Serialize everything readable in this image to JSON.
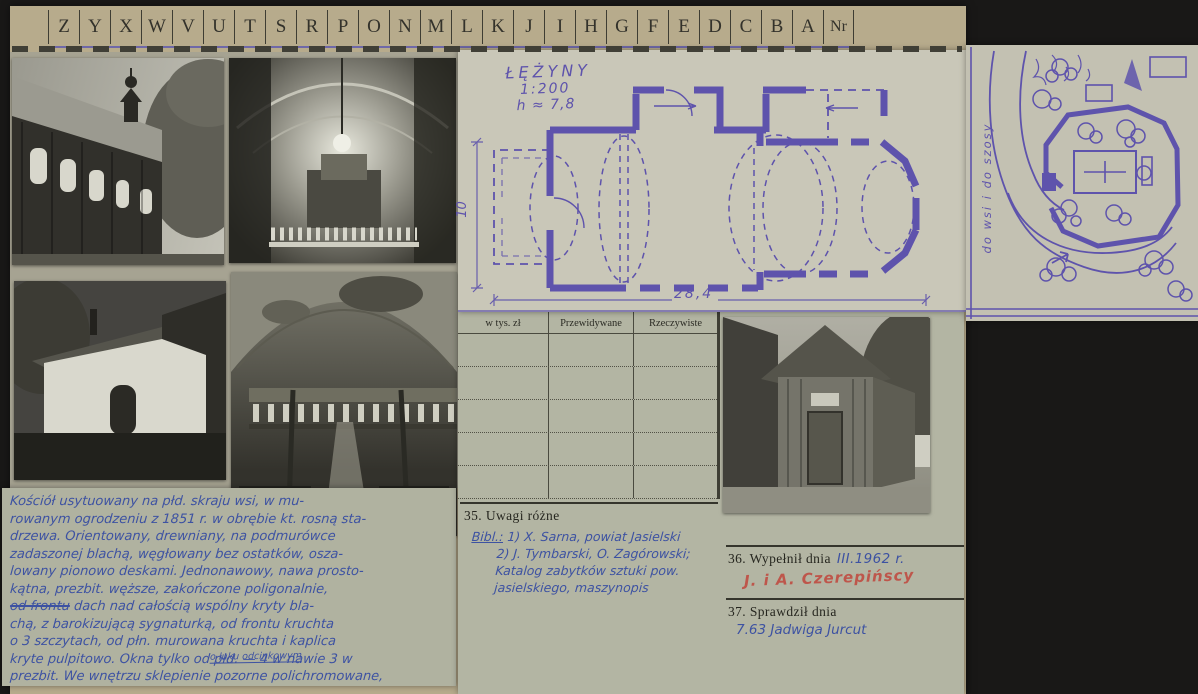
{
  "index_strip": {
    "letters": [
      "Z",
      "Y",
      "X",
      "W",
      "V",
      "U",
      "T",
      "S",
      "R",
      "P",
      "O",
      "N",
      "M",
      "L",
      "K",
      "J",
      "I",
      "H",
      "G",
      "F",
      "E",
      "D",
      "C",
      "B",
      "A"
    ],
    "last": "Nr"
  },
  "plan": {
    "title": "ŁĘŻYNY",
    "scale": "1:200",
    "height_note": "h ≈ 7,8",
    "width_dim": "28,4",
    "side_dim": "10"
  },
  "site_plan": {
    "road_label": "do wsi i do szosy"
  },
  "finance_table": {
    "col1": "w tys. zł",
    "col2": "Przewidywane",
    "col3": "Rzeczywiste"
  },
  "uwagi": {
    "label": "35. Uwagi różne",
    "lead": "Bibl.:",
    "line1": "1) X. Sarna, powiat Jasielski",
    "line2": "2) J. Tymbarski, O. Zagórowski;",
    "line3": "Katalog zabytków sztuki pow.",
    "line4": "jasielskiego, maszynopis"
  },
  "wypelnil": {
    "label": "36. Wypełnił dnia",
    "date": "III.1962 r.",
    "stamp": "J. i A. Czerepińscy"
  },
  "sprawdzil": {
    "label": "37. Sprawdził dnia",
    "note": "7.63 Jadwiga Jurcut"
  },
  "description": {
    "l0": "Kościół usytuowany na płd. skraju wsi, w mu-",
    "l1": "rowanym ogrodzeniu z 1851 r. w obrębie kt. rosną sta-",
    "l2": "drzewa. Orientowany, drewniany, na podmurówce",
    "l3": "zadaszonej blachą, węgłowany bez ostatków, osza-",
    "l4": "lowany pionowo deskami. Jednonawowy, nawa prosto-",
    "l5": "kątna, prezbit. węższe, zakończone poligonalnie,",
    "l6_struck": "od frontu",
    "l6": " dach nad całością wspólny kryty bla-",
    "l7": "chą, z barokizującą sygnaturką, od frontu kruchta",
    "l8": "o 3 szczytach, od płn. murowana kruchta i kaplica",
    "l9": "kryte pulpitowo. Okna tylko od płd. — 4 w nawie 3 w",
    "l10": "prezbit. We wnętrzu sklepienie pozorne polichromowane,",
    "insert": "o łuku odcinkowym"
  },
  "photos": {
    "p1": "wooden church exterior, south wall with ridge turret",
    "p2": "interior toward main altar",
    "p3": "plastered annex with arched doorway",
    "p4": "interior toward organ loft",
    "p5": "wooden porch with tented roof"
  },
  "colors": {
    "ink_purple": "#5e53ac",
    "ink_blue": "#3d52a2",
    "stamp_red": "#bf4f44"
  }
}
